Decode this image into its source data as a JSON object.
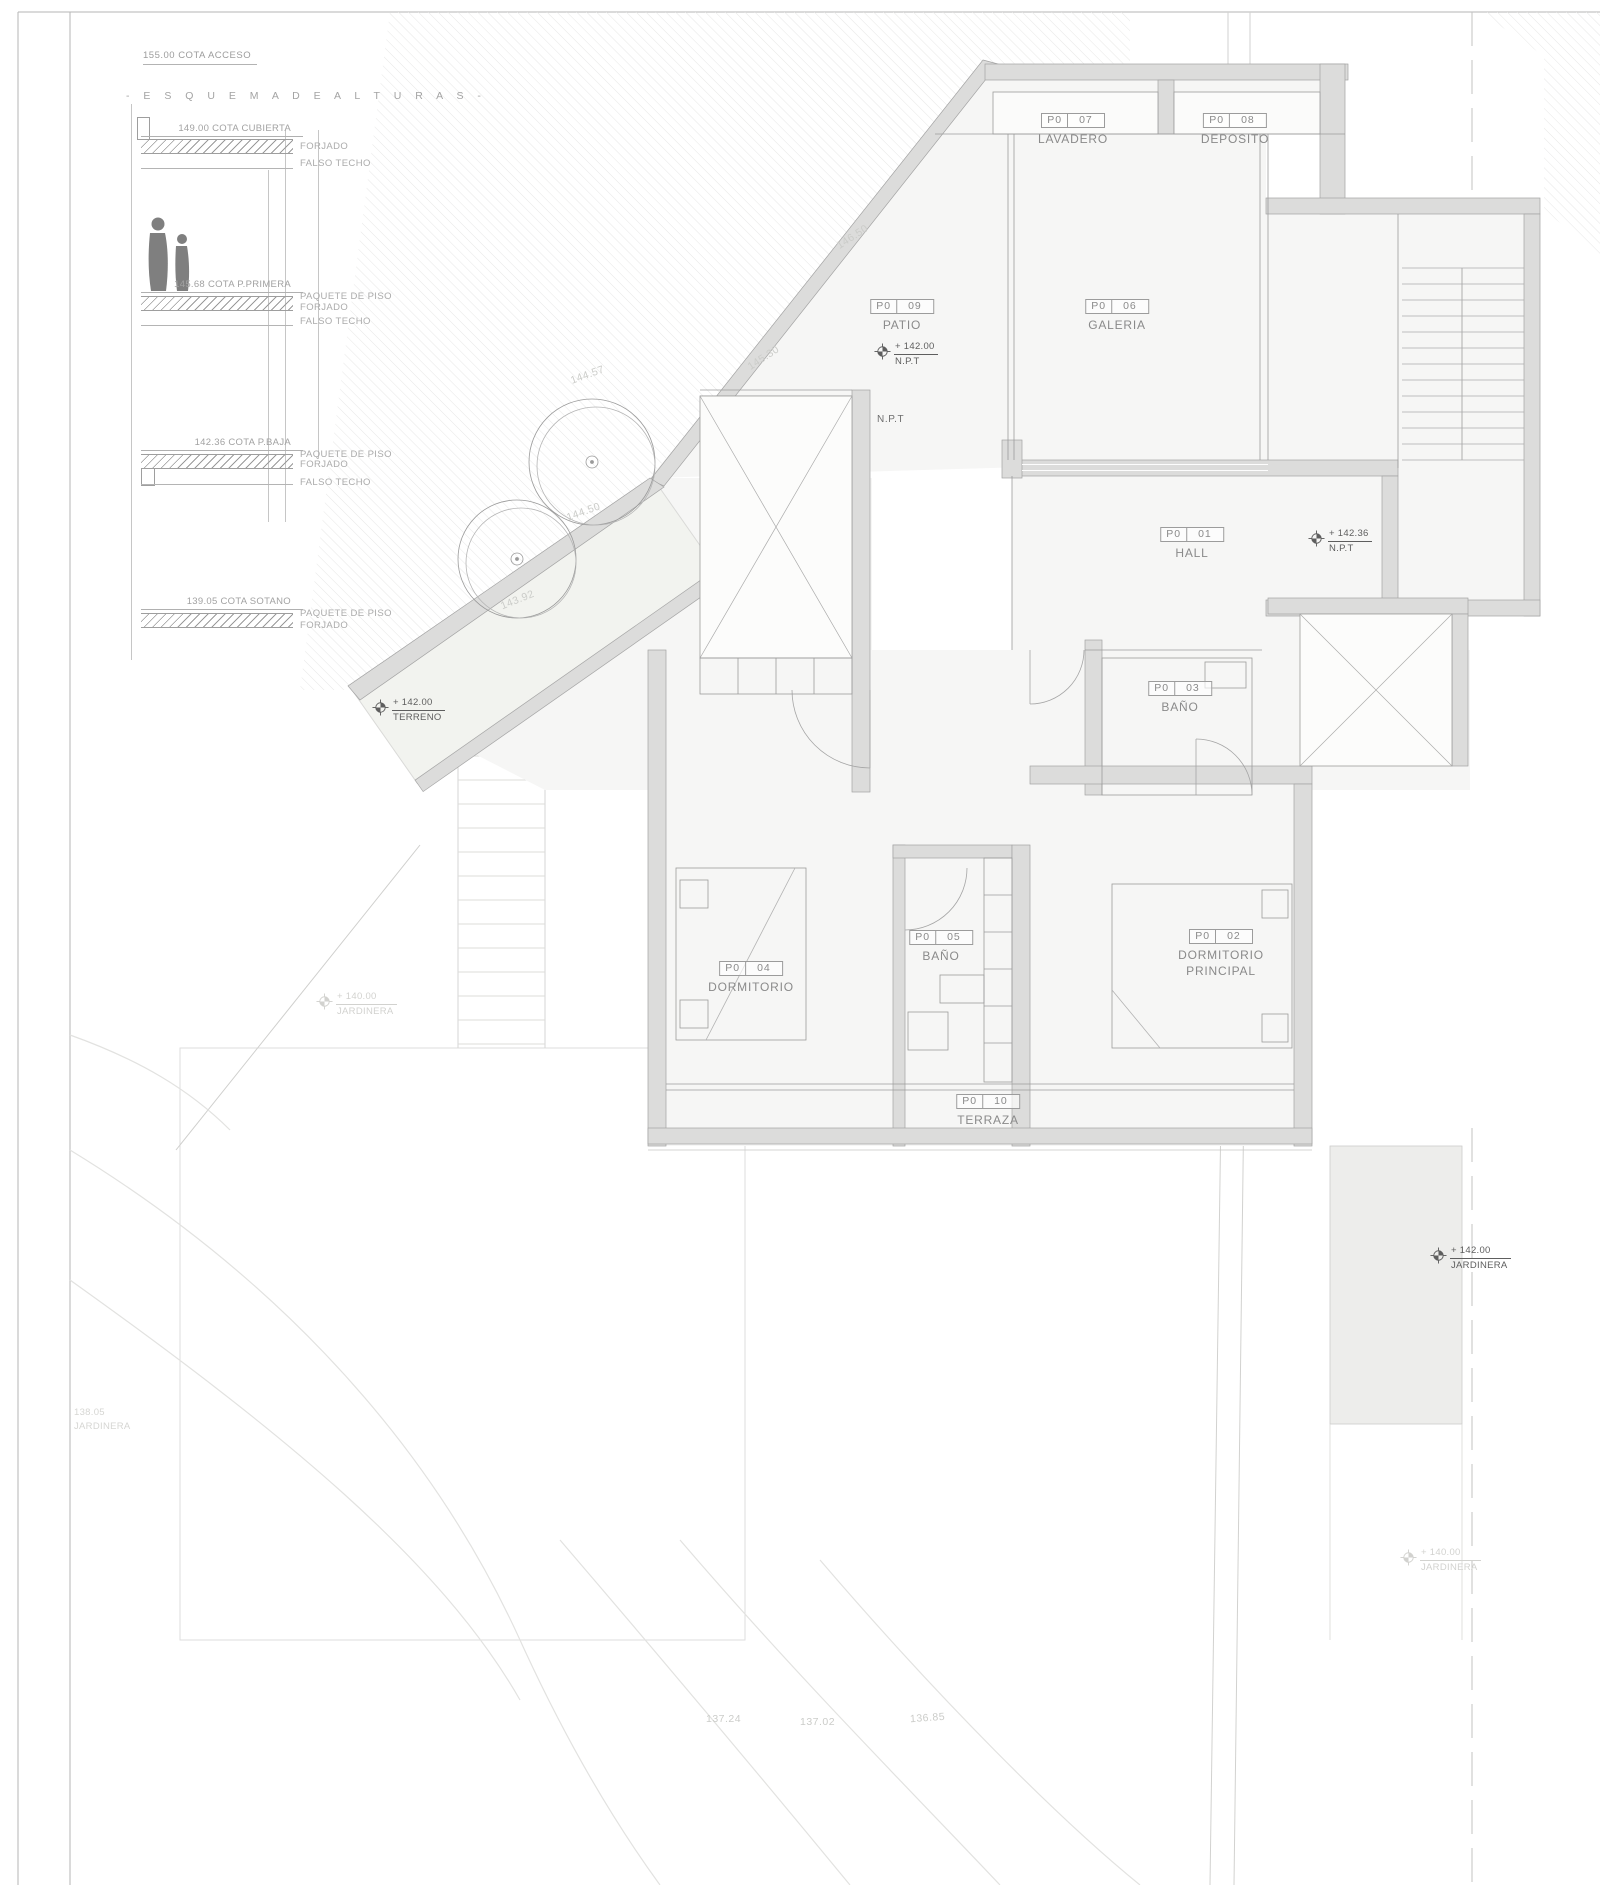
{
  "sheet": {
    "cota_acceso": "155.00 COTA ACCESO",
    "schema_heading": "-  E S Q U E M A   D E   A L T U R A S  -"
  },
  "esquema": {
    "levels": [
      {
        "cota": "149.00 COTA CUBIERTA",
        "side_labels": [
          "FORJADO",
          "FALSO TECHO"
        ]
      },
      {
        "cota": "145.68 COTA P.PRIMERA",
        "side_labels": [
          "PAQUETE DE PISO",
          "FORJADO",
          "FALSO TECHO"
        ]
      },
      {
        "cota": "142.36 COTA P.BAJA",
        "side_labels": [
          "PAQUETE DE PISO",
          "FORJADO",
          "FALSO TECHO"
        ]
      },
      {
        "cota": "139.05 COTA SOTANO",
        "side_labels": [
          "PAQUETE DE PISO",
          "FORJADO"
        ]
      }
    ]
  },
  "rooms": [
    {
      "code": "P0",
      "num": "07",
      "name": "LAVADERO"
    },
    {
      "code": "P0",
      "num": "08",
      "name": "DEPOSITO"
    },
    {
      "code": "P0",
      "num": "09",
      "name": "PATIO"
    },
    {
      "code": "P0",
      "num": "06",
      "name": "GALERIA"
    },
    {
      "code": "P0",
      "num": "01",
      "name": "HALL"
    },
    {
      "code": "P0",
      "num": "03",
      "name": "BAÑO"
    },
    {
      "code": "P0",
      "num": "05",
      "name": "BAÑO"
    },
    {
      "code": "P0",
      "num": "04",
      "name": "DORMITORIO"
    },
    {
      "code": "P0",
      "num": "02",
      "name": "DORMITORIO PRINCIPAL"
    },
    {
      "code": "P0",
      "num": "10",
      "name": "TERRAZA"
    }
  ],
  "markers": [
    {
      "value": "+ 142.00",
      "label": "N.P.T"
    },
    {
      "value": "+ 142.36",
      "label": "N.P.T"
    },
    {
      "value": "+ 142.00",
      "label": "TERRENO"
    },
    {
      "value": "+ 140.00",
      "label": "JARDINERA"
    },
    {
      "value": "+ 142.00",
      "label": "JARDINERA"
    },
    {
      "value": "+ 140.00",
      "label": "JARDINERA"
    }
  ],
  "annotations": {
    "npt": "N.P.T",
    "contours": [
      "146.50",
      "145.30",
      "144.57",
      "144.50",
      "143.92"
    ],
    "bottom_levels": [
      "137.24",
      "137.02",
      "136.85"
    ],
    "left_note": {
      "value": "138.05",
      "label": "JARDINERA"
    }
  }
}
